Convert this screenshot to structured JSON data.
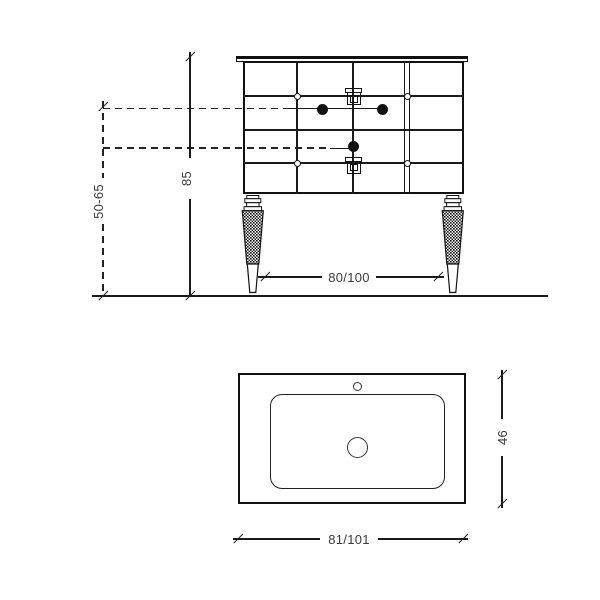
{
  "drawing": {
    "front_view": {
      "dim_height": "85",
      "dim_height_range": "50-65",
      "dim_width": "80/100"
    },
    "top_view": {
      "dim_depth": "46",
      "dim_width": "81/101"
    }
  },
  "colors": {
    "line": "#1a1a1a",
    "text": "#3a3a3a",
    "background": "#ffffff"
  }
}
